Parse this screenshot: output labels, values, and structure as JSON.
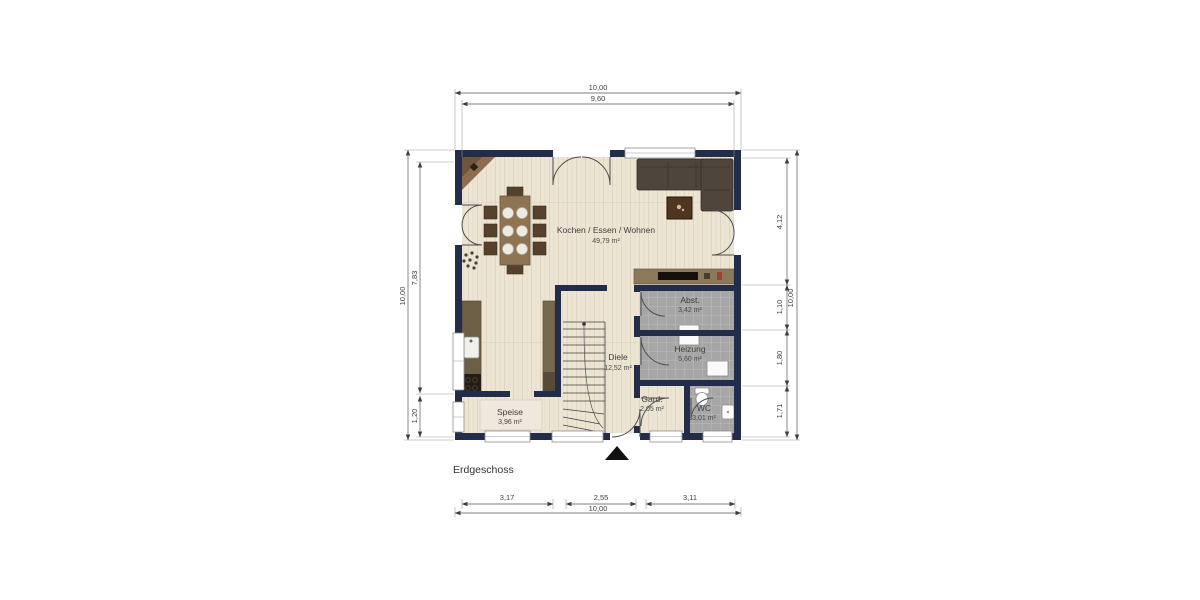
{
  "title": "Erdgeschoss",
  "rooms": {
    "living": {
      "name": "Kochen / Essen / Wohnen",
      "area": "49,79 m²"
    },
    "abst": {
      "name": "Abst.",
      "area": "3,42 m²"
    },
    "heizung": {
      "name": "Heizung",
      "area": "5,60 m²"
    },
    "diele": {
      "name": "Diele",
      "area": "12,52 m²"
    },
    "speise": {
      "name": "Speise",
      "area": "3,96 m²"
    },
    "gard": {
      "name": "Gard.",
      "area": "2,05 m²"
    },
    "wc": {
      "name": "WC",
      "area": "3,01 m²"
    }
  },
  "dimensions": {
    "top": {
      "total": "10,00",
      "inner": "9,60"
    },
    "left": {
      "total": "10,00",
      "upper": "7,83",
      "lower": "1,20"
    },
    "right": {
      "total": "10,00",
      "seg1": "4,12",
      "seg2": "1,10",
      "seg3": "1,80",
      "seg4": "1,71"
    },
    "bottom": {
      "total": "10,00",
      "seg1": "3,17",
      "seg2": "2,55",
      "seg3": "3,11"
    }
  },
  "colors": {
    "wall": "#232C49",
    "floor_wood": "#EDE5D3",
    "floor_tile": "#A6A6A6",
    "sofa": "#4E453D",
    "furniture_wood": "#8A795B",
    "kitchen_counter": "#6C5F45",
    "dimension_line": "#4A4A4A"
  }
}
